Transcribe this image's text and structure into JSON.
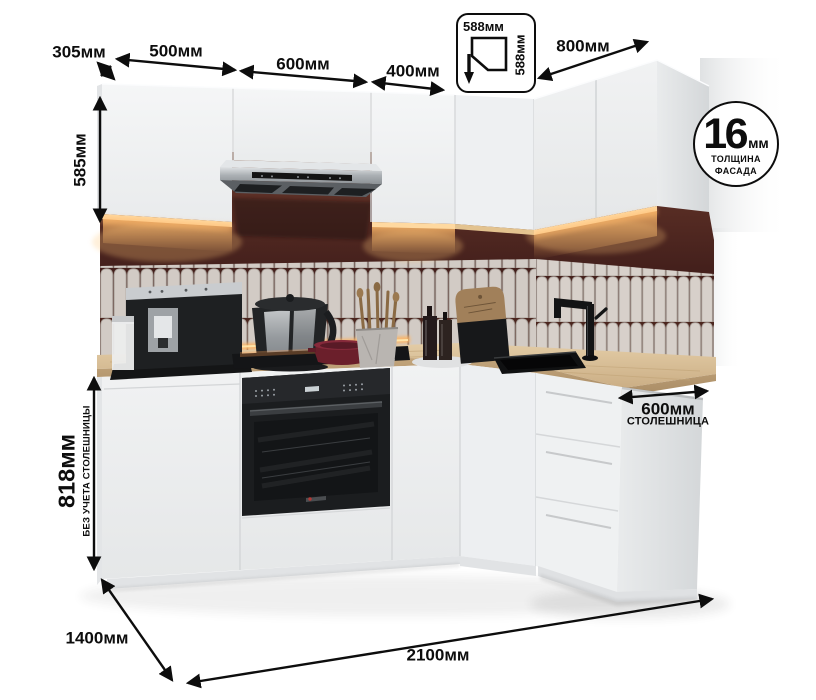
{
  "dims": {
    "d305": "305мм",
    "d500": "500мм",
    "d600": "600мм",
    "d400": "400мм",
    "corner_w": "588мм",
    "corner_h": "588мм",
    "d800": "800мм",
    "h585": "585мм",
    "h818": "818мм",
    "h818_note": "БЕЗ УЧЕТА СТОЛЕШНИЦЫ",
    "counter_depth": "600мм",
    "counter_depth_note": "СТОЛЕШНИЦА",
    "d1400": "1400мм",
    "d2100": "2100мм"
  },
  "badge": {
    "value": "16",
    "unit": "мм",
    "line1": "ТОЛЩИНА",
    "line2": "ФАСАДА"
  },
  "colors": {
    "annotation": "#0d0d0d",
    "cabinet_white": "#f2f3f4",
    "backsplash_maroon": "#46211d",
    "tile_beige": "#d2cbc5",
    "counter_wood": "#d6bc95",
    "appliance_black": "#17181a",
    "hood_steel": "#b9bdc0",
    "light_glow": "#ffd9a0"
  }
}
